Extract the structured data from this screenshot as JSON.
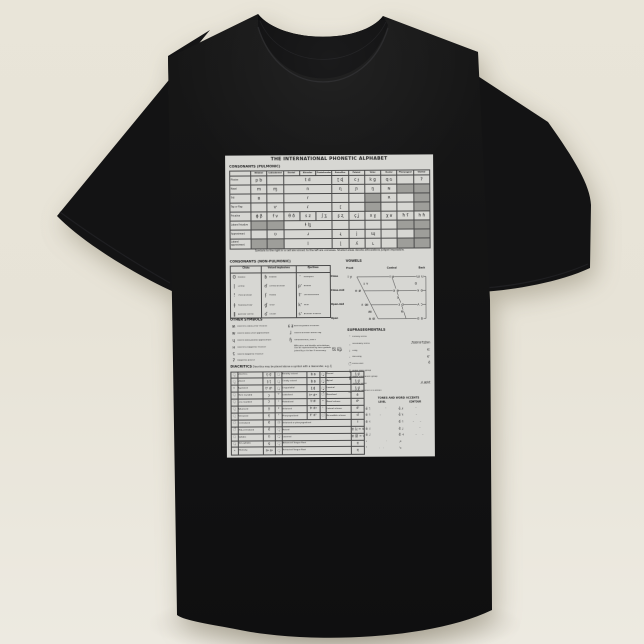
{
  "scene": {
    "background_top": "#e9e5d9",
    "background_bottom": "#edeae1",
    "shirt_color": "#141414",
    "paper_color": "#d7d7d3",
    "shaded_cell_color": "#9e9e9a",
    "ink_color": "#222222"
  },
  "chart": {
    "title": "THE INTERNATIONAL PHONETIC ALPHABET",
    "pulmonic": {
      "label": "CONSONANTS (PULMONIC)",
      "footnote": "Symbols to the right in a cell are voiced, to the left are voiceless. Shaded areas denote articulations judged impossible.",
      "columns": [
        "Bilabial",
        "Labiodental",
        "Dental",
        "Alveolar",
        "Postalveolar",
        "Retroflex",
        "Palatal",
        "Velar",
        "Uvular",
        "Pharyngeal",
        "Glottal"
      ],
      "rows": [
        {
          "label": "Plosive",
          "cells": [
            [
              "p b",
              1,
              0
            ],
            [
              "",
              1,
              0
            ],
            [
              "t d",
              3,
              0
            ],
            [
              "ʈ ɖ",
              1,
              0
            ],
            [
              "c ɟ",
              1,
              0
            ],
            [
              "k ɡ",
              1,
              0
            ],
            [
              "q ɢ",
              1,
              0
            ],
            [
              "",
              1,
              0
            ],
            [
              "ʔ",
              1,
              0
            ]
          ]
        },
        {
          "label": "Nasal",
          "cells": [
            [
              "m",
              1,
              0
            ],
            [
              "ɱ",
              1,
              0
            ],
            [
              "n",
              3,
              0
            ],
            [
              "ɳ",
              1,
              0
            ],
            [
              "ɲ",
              1,
              0
            ],
            [
              "ŋ",
              1,
              0
            ],
            [
              "ɴ",
              1,
              0
            ],
            [
              "",
              1,
              1
            ],
            [
              "",
              1,
              1
            ]
          ]
        },
        {
          "label": "Trill",
          "cells": [
            [
              "ʙ",
              1,
              0
            ],
            [
              "",
              1,
              0
            ],
            [
              "r",
              3,
              0
            ],
            [
              "",
              1,
              0
            ],
            [
              "",
              1,
              0
            ],
            [
              "",
              1,
              1
            ],
            [
              "ʀ",
              1,
              0
            ],
            [
              "",
              1,
              0
            ],
            [
              "",
              1,
              1
            ]
          ]
        },
        {
          "label": "Tap or Flap",
          "cells": [
            [
              "",
              1,
              0
            ],
            [
              "ⱱ",
              1,
              0
            ],
            [
              "ɾ",
              3,
              0
            ],
            [
              "ɽ",
              1,
              0
            ],
            [
              "",
              1,
              0
            ],
            [
              "",
              1,
              1
            ],
            [
              "",
              1,
              0
            ],
            [
              "",
              1,
              0
            ],
            [
              "",
              1,
              1
            ]
          ]
        },
        {
          "label": "Fricative",
          "cells": [
            [
              "ɸ β",
              1,
              0
            ],
            [
              "f v",
              1,
              0
            ],
            [
              "θ ð",
              1,
              0
            ],
            [
              "s z",
              1,
              0
            ],
            [
              "ʃ ʒ",
              1,
              0
            ],
            [
              "ʂ ʐ",
              1,
              0
            ],
            [
              "ç ʝ",
              1,
              0
            ],
            [
              "x ɣ",
              1,
              0
            ],
            [
              "χ ʁ",
              1,
              0
            ],
            [
              "ħ ʕ",
              1,
              0
            ],
            [
              "h ɦ",
              1,
              0
            ]
          ]
        },
        {
          "label": "Lateral fricative",
          "cells": [
            [
              "",
              1,
              1
            ],
            [
              "",
              1,
              1
            ],
            [
              "ɬ ɮ",
              3,
              0
            ],
            [
              "",
              1,
              0
            ],
            [
              "",
              1,
              0
            ],
            [
              "",
              1,
              0
            ],
            [
              "",
              1,
              0
            ],
            [
              "",
              1,
              1
            ],
            [
              "",
              1,
              1
            ]
          ]
        },
        {
          "label": "Approximant",
          "cells": [
            [
              "",
              1,
              0
            ],
            [
              "ʋ",
              1,
              0
            ],
            [
              "ɹ",
              3,
              0
            ],
            [
              "ɻ",
              1,
              0
            ],
            [
              "j",
              1,
              0
            ],
            [
              "ɰ",
              1,
              0
            ],
            [
              "",
              1,
              0
            ],
            [
              "",
              1,
              0
            ],
            [
              "",
              1,
              1
            ]
          ]
        },
        {
          "label": "Lateral approximant",
          "cells": [
            [
              "",
              1,
              1
            ],
            [
              "",
              1,
              1
            ],
            [
              "l",
              3,
              0
            ],
            [
              "ɭ",
              1,
              0
            ],
            [
              "ʎ",
              1,
              0
            ],
            [
              "ʟ",
              1,
              0
            ],
            [
              "",
              1,
              0
            ],
            [
              "",
              1,
              1
            ],
            [
              "",
              1,
              1
            ]
          ]
        }
      ]
    },
    "nonpulmonic": {
      "label": "CONSONANTS (NON-PULMONIC)",
      "groups": [
        {
          "header": "Clicks",
          "items": [
            [
              "ʘ",
              "Bilabial"
            ],
            [
              "ǀ",
              "Dental"
            ],
            [
              "ǃ",
              "(Post)alveolar"
            ],
            [
              "ǂ",
              "Palatoalveolar"
            ],
            [
              "ǁ",
              "Alveolar lateral"
            ]
          ]
        },
        {
          "header": "Voiced implosives",
          "items": [
            [
              "ɓ",
              "Bilabial"
            ],
            [
              "ɗ",
              "Dental/alveolar"
            ],
            [
              "ʄ",
              "Palatal"
            ],
            [
              "ɠ",
              "Velar"
            ],
            [
              "ʛ",
              "Uvular"
            ]
          ]
        },
        {
          "header": "Ejectives",
          "items": [
            [
              "ʼ",
              "Examples:"
            ],
            [
              "pʼ",
              "Bilabial"
            ],
            [
              "tʼ",
              "Dental/alveolar"
            ],
            [
              "kʼ",
              "Velar"
            ],
            [
              "sʼ",
              "Alveolar fricative"
            ]
          ]
        }
      ]
    },
    "vowels": {
      "label": "VOWELS",
      "col_headers": [
        "Front",
        "Central",
        "Back"
      ],
      "row_labels": [
        "Close",
        "Close-mid",
        "Open-mid",
        "Open"
      ],
      "points": [
        {
          "t": "i y",
          "x": 20,
          "y": 11
        },
        {
          "t": "ɨ ʉ",
          "x": 62,
          "y": 11
        },
        {
          "t": "ɯ u",
          "x": 90,
          "y": 11
        },
        {
          "t": "ɪ ʏ",
          "x": 36,
          "y": 18.5
        },
        {
          "t": "ʊ",
          "x": 86,
          "y": 18.5
        },
        {
          "t": "e ø",
          "x": 28,
          "y": 25
        },
        {
          "t": "ɘ ɵ",
          "x": 66,
          "y": 25
        },
        {
          "t": "ɤ o",
          "x": 90,
          "y": 25
        },
        {
          "t": "ə",
          "x": 68,
          "y": 32
        },
        {
          "t": "ɛ œ",
          "x": 35,
          "y": 39
        },
        {
          "t": "ɜ ɞ",
          "x": 71,
          "y": 39
        },
        {
          "t": "ʌ ɔ",
          "x": 90,
          "y": 39
        },
        {
          "t": "æ",
          "x": 40,
          "y": 46
        },
        {
          "t": "ɐ",
          "x": 72,
          "y": 46
        },
        {
          "t": "a ɶ",
          "x": 42,
          "y": 53
        },
        {
          "t": "ɑ ɒ",
          "x": 90,
          "y": 53
        }
      ]
    },
    "other_symbols": {
      "label": "OTHER SYMBOLS",
      "left": [
        [
          "ʍ",
          "Voiceless labial-velar fricative"
        ],
        [
          "w",
          "Voiced labial-velar approximant"
        ],
        [
          "ɥ",
          "Voiced labial-palatal approximant"
        ],
        [
          "ʜ",
          "Voiceless epiglottal fricative"
        ],
        [
          "ʢ",
          "Voiced epiglottal fricative"
        ],
        [
          "ʡ",
          "Epiglottal plosive"
        ]
      ],
      "right": [
        [
          "ɕ ʑ",
          "Alveolo-palatal fricatives"
        ],
        [
          "ɺ",
          "Voiced alveolar lateral flap"
        ],
        [
          "ɧ",
          "Simultaneous ʃ and x"
        ]
      ],
      "affricate_note": "Affricates and double articulations can be represented by two symbols joined by a tie bar if necessary.",
      "affricate_examples": "t͡s  k͡p"
    },
    "diacritics": {
      "label": "DIACRITICS",
      "caption": "Diacritics may be placed above a symbol with a descender, e.g. ŋ̊",
      "rows": [
        [
          [
            "◌̥",
            "Voiceless",
            "n̥ d̥"
          ],
          [
            "◌̤",
            "Breathy voiced",
            "b̤ a̤"
          ],
          [
            "◌̪",
            "Dental",
            "t̪ d̪"
          ]
        ],
        [
          [
            "◌̬",
            "Voiced",
            "s̬ t̬"
          ],
          [
            "◌̰",
            "Creaky voiced",
            "b̰ a̰"
          ],
          [
            "◌̺",
            "Apical",
            "t̺ d̺"
          ]
        ],
        [
          [
            "ʰ",
            "Aspirated",
            "tʰ dʰ"
          ],
          [
            "◌̼",
            "Linguolabial",
            "t̼ d̼"
          ],
          [
            "◌̻",
            "Laminal",
            "t̻ d̻"
          ]
        ],
        [
          [
            "◌̹",
            "More rounded",
            "ɔ̹"
          ],
          [
            "ʷ",
            "Labialized",
            "tʷ dʷ"
          ],
          [
            "◌̃",
            "Nasalized",
            "ẽ"
          ]
        ],
        [
          [
            "◌̜",
            "Less rounded",
            "ɔ̜"
          ],
          [
            "ʲ",
            "Palatalized",
            "tʲ dʲ"
          ],
          [
            "ⁿ",
            "Nasal release",
            "dⁿ"
          ]
        ],
        [
          [
            "◌̟",
            "Advanced",
            "u̟"
          ],
          [
            "ˠ",
            "Velarized",
            "tˠ dˠ"
          ],
          [
            "ˡ",
            "Lateral release",
            "dˡ"
          ]
        ],
        [
          [
            "◌̠",
            "Retracted",
            "e̠"
          ],
          [
            "ˤ",
            "Pharyngealized",
            "tˤ dˤ"
          ],
          [
            "◌̚",
            "No audible release",
            "d̚"
          ]
        ],
        [
          [
            "◌̈",
            "Centralized",
            "ë"
          ],
          [
            "◌̴",
            "Velarized or pharyngealized",
            "ɫ",
            2
          ]
        ],
        [
          [
            "◌̽",
            "Mid-centralized",
            "e̽"
          ],
          [
            "◌̝",
            "Raised",
            "e̝ (ɹ̝ = voiced alveolar fricative)",
            2
          ]
        ],
        [
          [
            "◌̩",
            "Syllabic",
            "n̩"
          ],
          [
            "◌̞",
            "Lowered",
            "e̞ (β̞ = voiced bilabial approximant)",
            2
          ]
        ],
        [
          [
            "◌̯",
            "Non-syllabic",
            "e̯"
          ],
          [
            "◌̘",
            "Advanced Tongue Root",
            "e̘",
            2
          ]
        ],
        [
          [
            "˞",
            "Rhoticity",
            "ə˞ a˞"
          ],
          [
            "◌̙",
            "Retracted Tongue Root",
            "e̙",
            2
          ]
        ]
      ]
    },
    "suprasegmentals": {
      "label": "SUPRASEGMENTALS",
      "items": [
        [
          "ˈ",
          "Primary stress",
          ""
        ],
        [
          "ˌ",
          "Secondary stress",
          "ˌfoʊnəˈtɪʃən"
        ],
        [
          "ː",
          "Long",
          "eː"
        ],
        [
          "ˑ",
          "Half-long",
          "eˑ"
        ],
        [
          "◌̆",
          "Extra-short",
          "ĕ"
        ],
        [
          "|",
          "Minor (foot) group",
          ""
        ],
        [
          "‖",
          "Major (intonation) group",
          ""
        ],
        [
          ".",
          "Syllable break",
          "ɹi.ækt"
        ],
        [
          "‿",
          "Linking (absence of a break)",
          ""
        ]
      ]
    },
    "tones": {
      "label": "TONES AND WORD ACCENTS",
      "level_header": "LEVEL",
      "contour_header": "CONTOUR",
      "level": [
        [
          "e̋ ˥",
          "Extra high"
        ],
        [
          "é ˦",
          "High"
        ],
        [
          "ē ˧",
          "Mid"
        ],
        [
          "è ˨",
          "Low"
        ],
        [
          "ȅ ˩",
          "Extra low"
        ]
      ],
      "contour": [
        [
          "ě ˩˥",
          "Rising"
        ],
        [
          "ê ˥˩",
          "Falling"
        ],
        [
          "e᷄ ˦˥",
          "High rising"
        ],
        [
          "e᷅ ˩˨",
          "Low rising"
        ],
        [
          "e᷈ ˧˦˧",
          "Rising-falling"
        ]
      ],
      "extras": [
        [
          "ꜜ",
          "Downstep",
          "↗",
          "Global rise"
        ],
        [
          "ꜛ",
          "Upstep",
          "↘",
          "Global fall"
        ]
      ]
    }
  }
}
